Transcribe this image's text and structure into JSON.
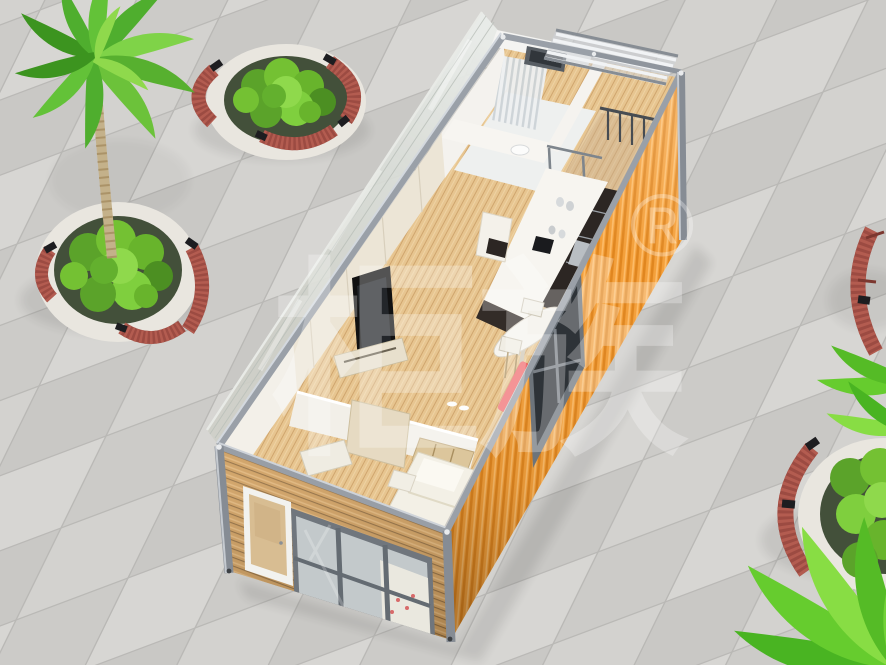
{
  "scene": {
    "kind": "3d-architectural-render",
    "subject": "Open-top cutaway view of an orange flat-pack container house on a tiled plaza with palm trees, round stone planters and curved wooden benches"
  },
  "watermark": {
    "brand_text": "柜族",
    "registered_mark": "®"
  },
  "palette": {
    "plaza_tile_light": "#d6d5d2",
    "plaza_tile_dark": "#c9c8c5",
    "plaza_grout": "#b9b8b5",
    "container_orange": "#f39b34",
    "container_orange_shade": "#e0861f",
    "wood_siding": "#cd9c5c",
    "steel_frame": "#9aa0a8",
    "interior_wall": "#f2efe8",
    "wood_floor": "#e7c590",
    "kitchen_cabinet": "#2c2623",
    "countertop": "#f7f5f0",
    "sofa_red": "#e8474b",
    "bed_linen": "#f3f0e6",
    "bench_wood": "#9c4b42",
    "planter_stone": "#e9e6df",
    "foliage_green": "#68b42c",
    "palm_trunk": "#c4b18a",
    "glass": "#ccd3d6"
  },
  "rooms": {
    "list": [
      "balcony",
      "bathroom",
      "kitchen",
      "bar-dining",
      "living-room",
      "bedroom"
    ]
  },
  "furnishings": {
    "list": [
      "pergola-louvers",
      "balcony-railing",
      "shower-screen",
      "kitchen-cabinets",
      "range-hood",
      "bar-table",
      "bar-stools",
      "wall-tv",
      "media-console",
      "red-sofa",
      "bed",
      "headboard-shelf",
      "wardrobe",
      "entry-door",
      "front-window"
    ]
  },
  "landscaping": {
    "list": [
      "palm-tree",
      "round-stone-planter",
      "curved-bench",
      "shrubs"
    ]
  }
}
